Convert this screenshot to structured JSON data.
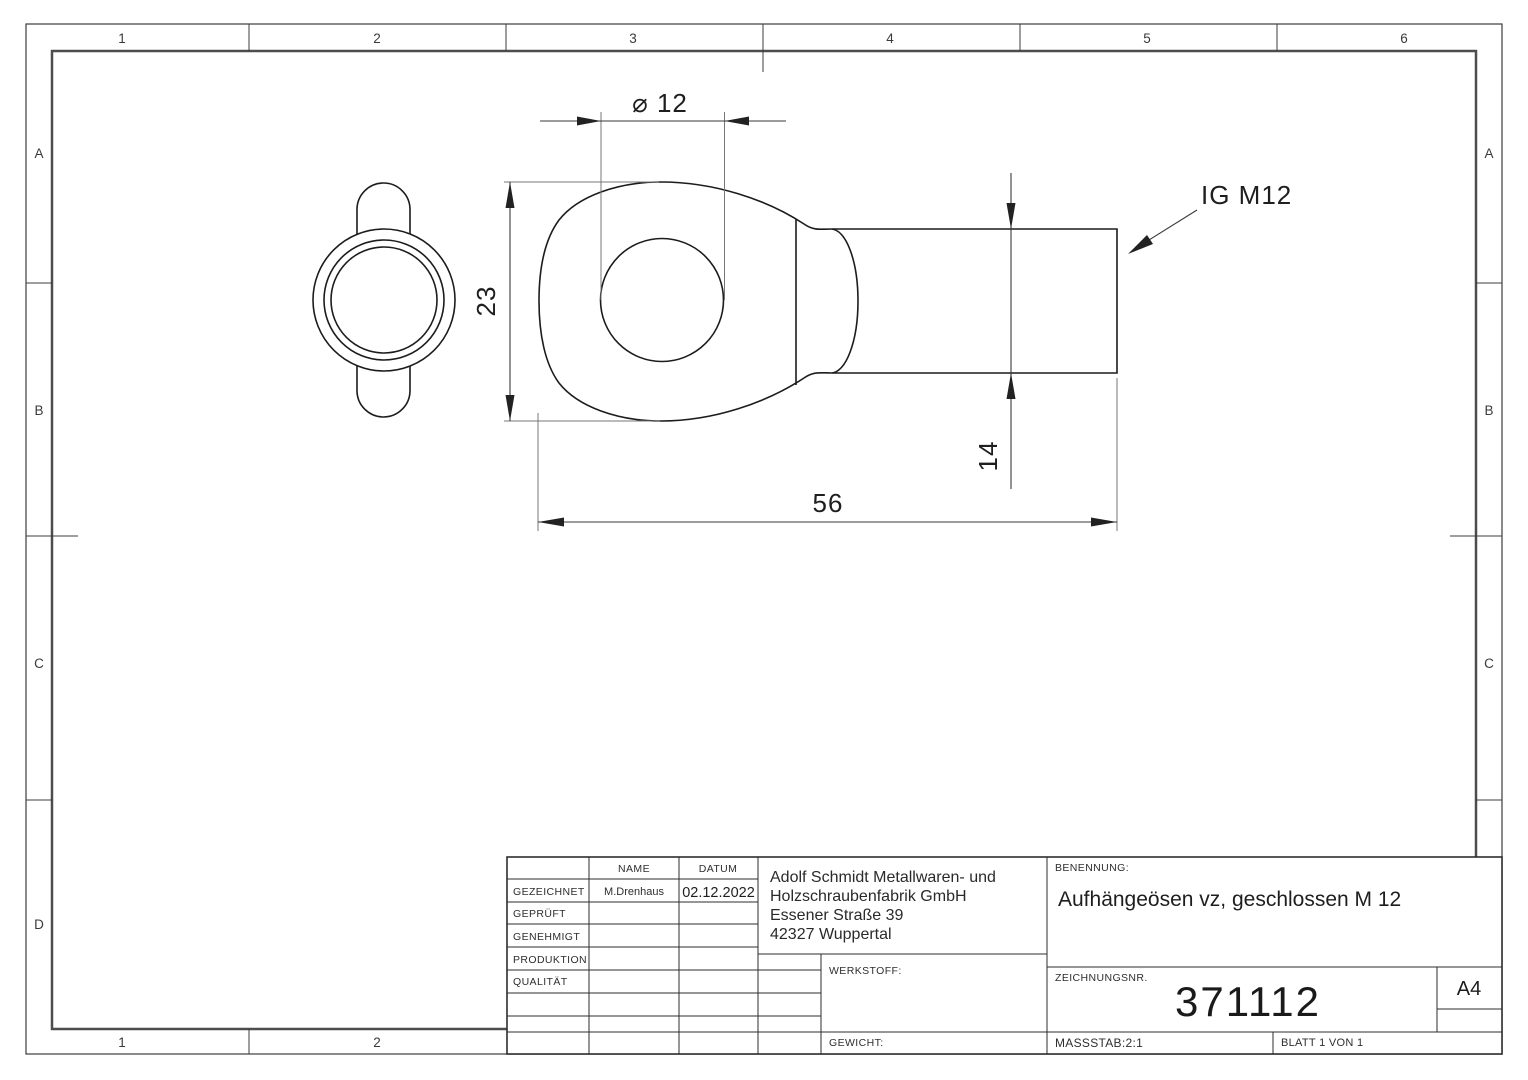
{
  "zones": {
    "columns": [
      "1",
      "2",
      "3",
      "4",
      "5",
      "6"
    ],
    "rows": [
      "A",
      "B",
      "C",
      "D"
    ]
  },
  "dimensions": {
    "hole_diameter": "⌀ 12",
    "eye_height": "23",
    "total_length": "56",
    "shaft_diameter": "14",
    "thread_label": "IG M12"
  },
  "title_block": {
    "name_header": "NAME",
    "date_header": "DATUM",
    "drawn_label": "GEZEICHNET",
    "checked_label": "GEPRÜFT",
    "approved_label": "GENEHMIGT",
    "production_label": "PRODUKTION",
    "quality_label": "QUALITÄT",
    "drawn_name": "M.Drenhaus",
    "drawn_date": "02.12.2022",
    "company_lines": [
      "Adolf Schmidt Metallwaren- und",
      "Holzschraubenfabrik GmbH",
      "Essener Straße 39",
      "42327 Wuppertal"
    ],
    "material_label": "WERKSTOFF:",
    "weight_label": "GEWICHT:",
    "designation_label": "BENENNUNG:",
    "designation": "Aufhängeösen vz, geschlossen M 12",
    "drawing_no_label": "ZEICHNUNGSNR.",
    "drawing_no": "371112",
    "paper_size": "A4",
    "scale": "MASSSTAB:2:1",
    "sheet": "BLATT 1 VON 1"
  }
}
